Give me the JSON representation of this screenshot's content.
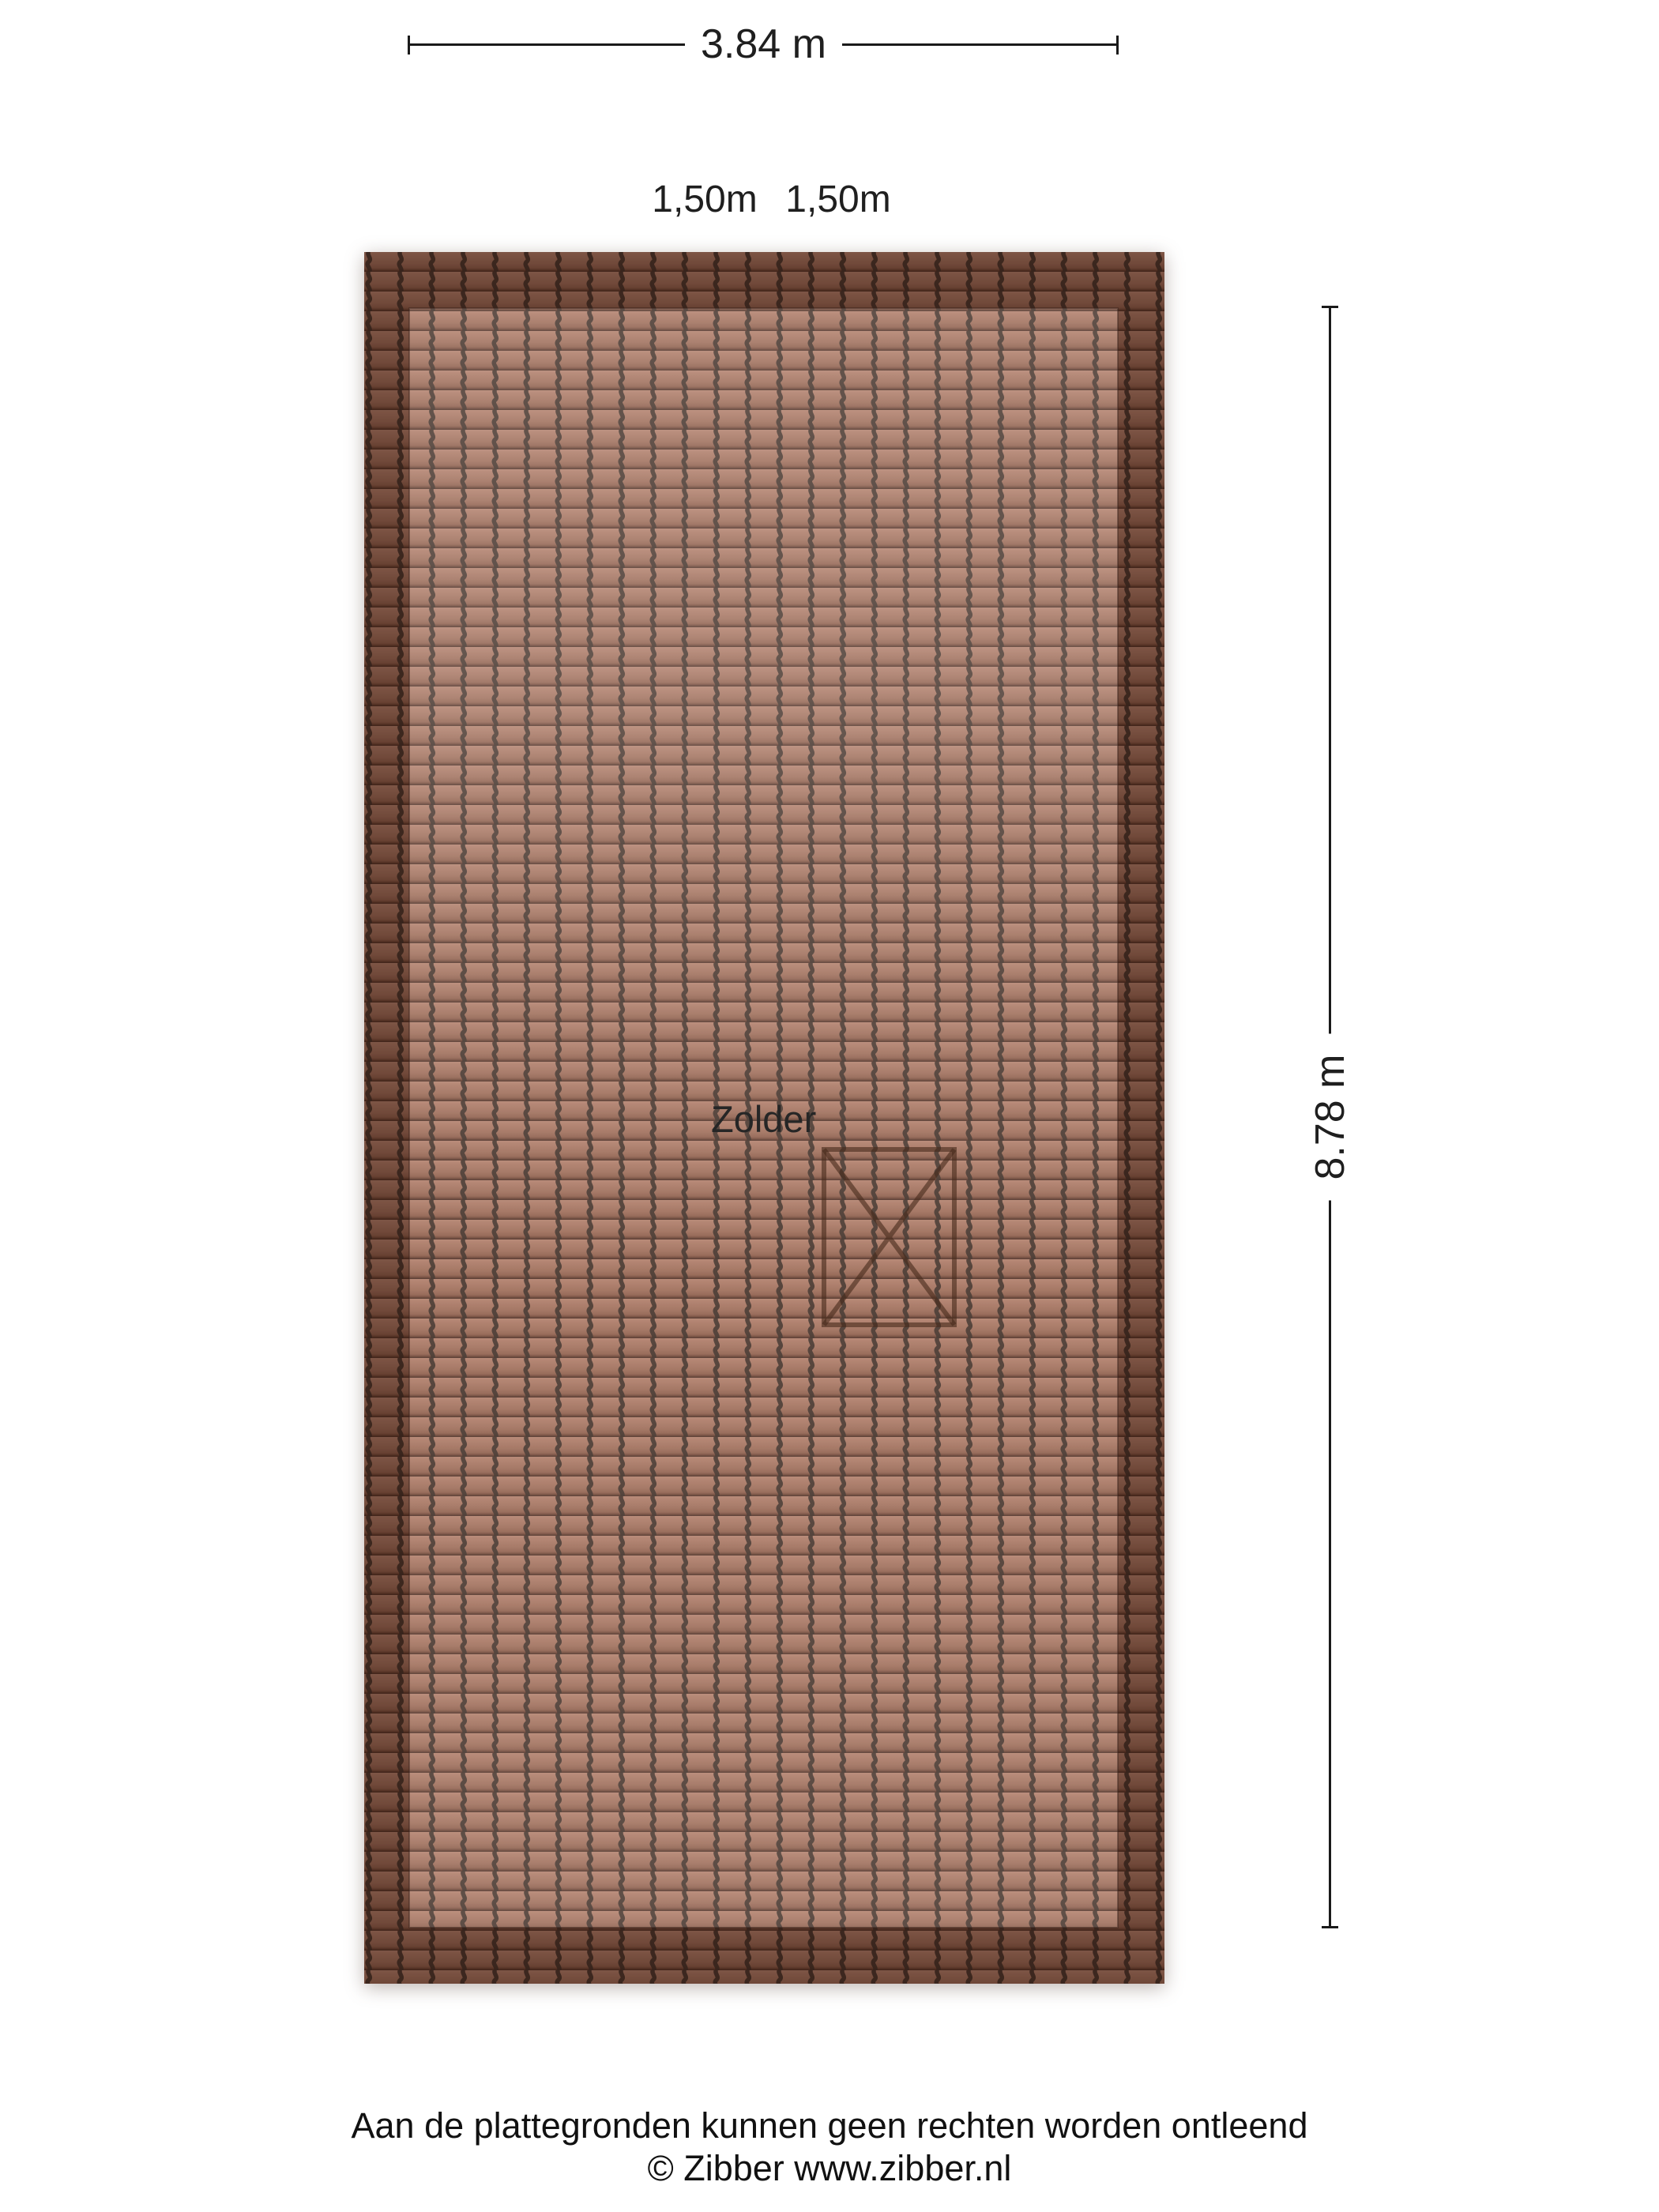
{
  "dimensions": {
    "width_label": "3.84 m",
    "height_label": "8.78 m",
    "section_labels": [
      "1,50m",
      "1,50m"
    ]
  },
  "room": {
    "name": "Zolder"
  },
  "footer": {
    "disclaimer": "Aan de plattegronden kunnen geen rechten worden ontleend",
    "copyright": "© Zibber www.zibber.nl"
  },
  "colors": {
    "background": "#ffffff",
    "dimension_line": "#1a1a1a",
    "text": "#1f1f1f",
    "tile_light": "#b2806c",
    "tile_base": "#9d6c58",
    "tile_row_shadow": "#4c2e23",
    "tile_groove": "#3d2d26",
    "roof_border_shade": "#2a130a",
    "stair_marker": "#46291b"
  }
}
